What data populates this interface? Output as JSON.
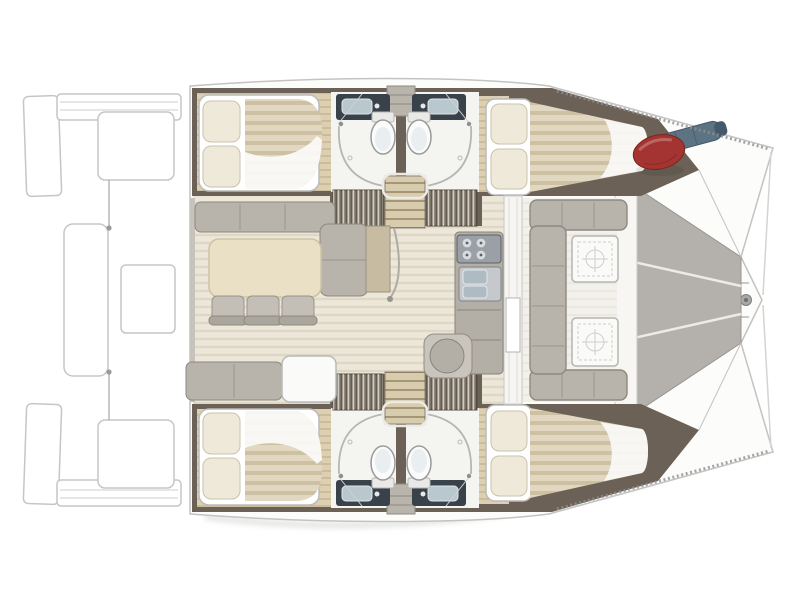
{
  "meta": {
    "type": "floor-plan",
    "subject": "catamaran-yacht-deck-plan",
    "view": "top-down",
    "orientation": "bow-right-stern-left"
  },
  "palette": {
    "deck": "#fcfcfb",
    "outline": "#c3c3c1",
    "wall": "#6b6156",
    "wood": "#dccfb2",
    "saloon_floor": "#ece7d9",
    "cockpit_floor": "#f3f1ec",
    "mattress": "#e2d8c1",
    "duvet": "#fbfbf9",
    "pillow": "#efe9da",
    "sofa": "#b8b3ab",
    "sofa_edge": "#8e897f",
    "table": "#e9e0c6",
    "chair": "#c3bfb7",
    "white_table": "#fafaf9",
    "counter": "#b3aea6",
    "stove": "#9aa0a6",
    "sink_steel": "#aebbc2",
    "counter_dark": "#39424a",
    "basin": "#b9c7cf",
    "bathroom_floor": "#f4f4f1",
    "toilet": "#fbfbfb",
    "trampoline": "#b4b1ad",
    "tramp_seam": "#ecebe7",
    "wardrobe": "#958c7f",
    "stairs": "#d8ccae",
    "fender": "#a33431",
    "gear_roll": "#5b7383",
    "tan_panel": "#c7bca2",
    "bulkhead": "#f6f5f2",
    "platform": "#ffffff"
  },
  "components": {
    "swim_platforms": 2,
    "aft_cabins": 2,
    "forward_cabins": 2,
    "beds": 4,
    "pillows_per_bed": 2,
    "bathrooms": 4,
    "toilets": 4,
    "sinks": 4,
    "showers": 4,
    "companionway_stairs": 2,
    "wardrobes": 4,
    "dining_chairs": 3,
    "dining_tables": 1,
    "galley_burners": 4,
    "galley_basins": 2,
    "cockpit_tables": 2,
    "trampoline_panels": 3
  },
  "objects_on_deck": [
    {
      "name": "red-fender",
      "color": "#a33431",
      "location": "port-bow-locker"
    },
    {
      "name": "blue-rolled-gear",
      "color": "#5b7383",
      "location": "port-bow-locker"
    }
  ]
}
